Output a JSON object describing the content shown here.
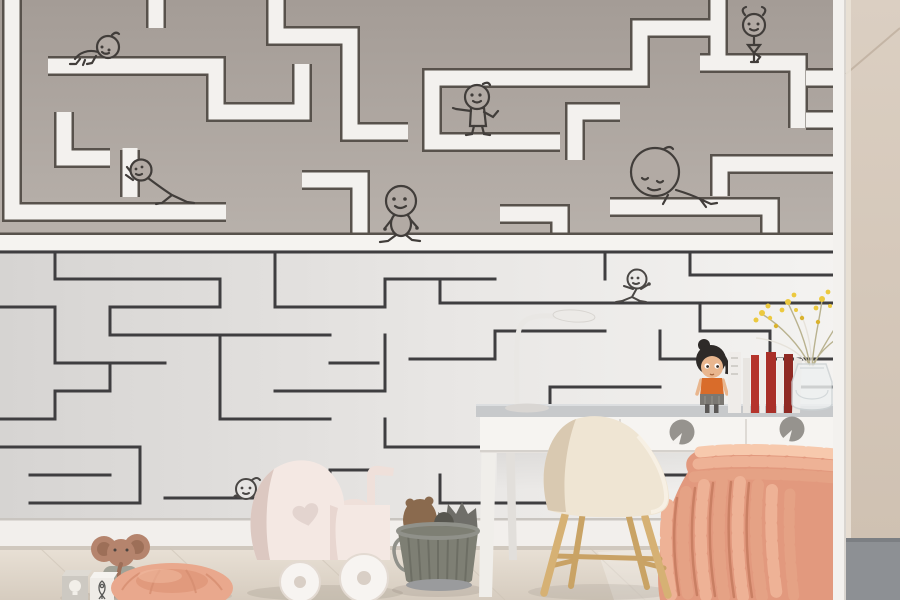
{
  "scene": {
    "setting": "Corner of a children's room decorated with a maze-mural wallpaper, a white desk with chair, a window bench with a chunky knit blanket and toys on a pale wooden floor",
    "wallpaper": {
      "upper_mural": "Dark taupe wall crossed by thick white maze corridors with thin dark outlines",
      "lower_mural": "Pale gray wall with a dense thin-line maze",
      "stick_figures": [
        {
          "name": "crawling-baby",
          "pose": "crawling along a white corridor",
          "area": "top left"
        },
        {
          "name": "pushing-figure",
          "pose": "leaning forward pushing a maze wall",
          "area": "mid left"
        },
        {
          "name": "pointing-figure",
          "pose": "standing with one arm stretched out",
          "area": "top middle"
        },
        {
          "name": "walking-figure",
          "pose": "strolling on the white divider band",
          "area": "middle"
        },
        {
          "name": "balancing-figure",
          "pose": "balancing with hands up",
          "area": "top right"
        },
        {
          "name": "resting-figure",
          "pose": "big-headed figure lounging on a corridor",
          "area": "right"
        },
        {
          "name": "running-figure",
          "pose": "jogging along a thin maze line",
          "area": "center"
        },
        {
          "name": "peeking-figure",
          "pose": "peeking over a maze line",
          "area": "lower left"
        }
      ]
    },
    "furniture": [
      {
        "name": "desk",
        "details": "white desk, gray top, two drawers with round gray knobs"
      },
      {
        "name": "shell-chair",
        "details": "cream shell chair with splayed wooden legs"
      },
      {
        "name": "bench",
        "details": "white storage bench with gray cushion"
      },
      {
        "name": "wardrobe",
        "details": "beige wardrobe panel on the right edge"
      }
    ],
    "objects_on_desk": [
      {
        "name": "desk-lamp",
        "details": "thin white arched lamp"
      },
      {
        "name": "doll",
        "details": "dark-haired doll in orange top"
      },
      {
        "name": "books",
        "details": "row of white and red books and binders"
      },
      {
        "name": "vase",
        "details": "glass vase with yellow sprig flowers"
      }
    ],
    "toys": [
      {
        "name": "toy-pram",
        "details": "pale pink wooden doll pram with heart cutout"
      },
      {
        "name": "bucket",
        "details": "ribbed olive bucket holding plush animals"
      },
      {
        "name": "wooden-elephant",
        "details": "elephant toy with terracotta head"
      },
      {
        "name": "toy-blocks",
        "details": "two blocks with lightbulb and rocket doodles"
      },
      {
        "name": "floor-pouf",
        "details": "round peach pouf"
      }
    ]
  },
  "colors": {
    "wall": {
      "upper_bg_top": "#a49c96",
      "upper_bg_bottom": "#b9b2ac",
      "corridor_white": "#f3f1ee",
      "corridor_outline": "#58524c",
      "lower_bg_left": "#d6d4d2",
      "lower_bg_right": "#f4f3f1",
      "lower_line": "#3f3e40",
      "ink_upper": "#413d3a",
      "ink_lower": "#4a4745"
    },
    "wardrobe": {
      "beige_top": "#dbcfc2",
      "beige_bottom": "#cfc1b2",
      "seam": "#c4b5a5",
      "trim_white": "#f3f1ee",
      "plinth_gray": "#8d9094"
    },
    "desk": {
      "top_gray": "#c7c9cb",
      "front_white": "#f6f4f1",
      "divider": "#dedad5",
      "knob_gray": "#96938e",
      "knob_notch": "#f4f2ef",
      "leg_white": "#f0eeea"
    },
    "chair": {
      "shell_cream": "#efe5d3",
      "shell_shade": "#d9c9b1",
      "leg_wood": "#d6b174",
      "stretcher_wood": "#c9a265",
      "mount_metal": "#6b6560"
    },
    "bench": {
      "front_white": "#f1efec",
      "cushion_gray": "#9da2a6",
      "cushion_highlight": "#c3c7ca"
    },
    "blanket": {
      "base": "#e2997e",
      "braid_light": "#eeb296",
      "braid_mid": "#e5a285",
      "braid_dark": "#c97f63",
      "highlight": "#f7c9ad"
    },
    "floor": {
      "light": "#e9e1d6",
      "dark": "#d6ccbf",
      "plank_line": "#cfc5b8",
      "baseboard": "#f2efec",
      "shadow": "#6a6058"
    },
    "toys": {
      "pram_body": "#f4e8e3",
      "pram_shade": "#dcc8c1",
      "pram_heart": "#e3d4cf",
      "wheel_white": "#f7f4f1",
      "wheel_hub": "#d9cfc6",
      "bucket_olive": "#7e7f74",
      "bucket_rib": "#6a6b61",
      "bucket_rim": "#90918a",
      "plush_brown": "#8a6a4e",
      "plush_gray": "#6f6e69",
      "elephant_body": "#a2a398",
      "elephant_head": "#b5846d",
      "elephant_ear_inner": "#9d6f58",
      "block_gray": "#cdc9c2",
      "block_white": "#efece7",
      "block_icon": "#5a5a58",
      "pouf": "#e9a88d",
      "pouf_shade": "#d68d70"
    },
    "desk_items": {
      "lamp_white": "#e9e7e4",
      "lamp_line": "#d8d5d1",
      "doll_hair": "#2e2a28",
      "doll_skin": "#e9b68e",
      "doll_top": "#d96c2a",
      "doll_skirt": "#7b7873",
      "book_red": "#b5342c",
      "book_red_dark": "#8f2a24",
      "book_white": "#efece9",
      "vase_glass": "#eef0f0",
      "vase_outline": "#ccd2d4",
      "flower_yellow": "#ecc93f",
      "flower_yellow_dark": "#d9b22e",
      "stem": "#b9b28f"
    }
  }
}
